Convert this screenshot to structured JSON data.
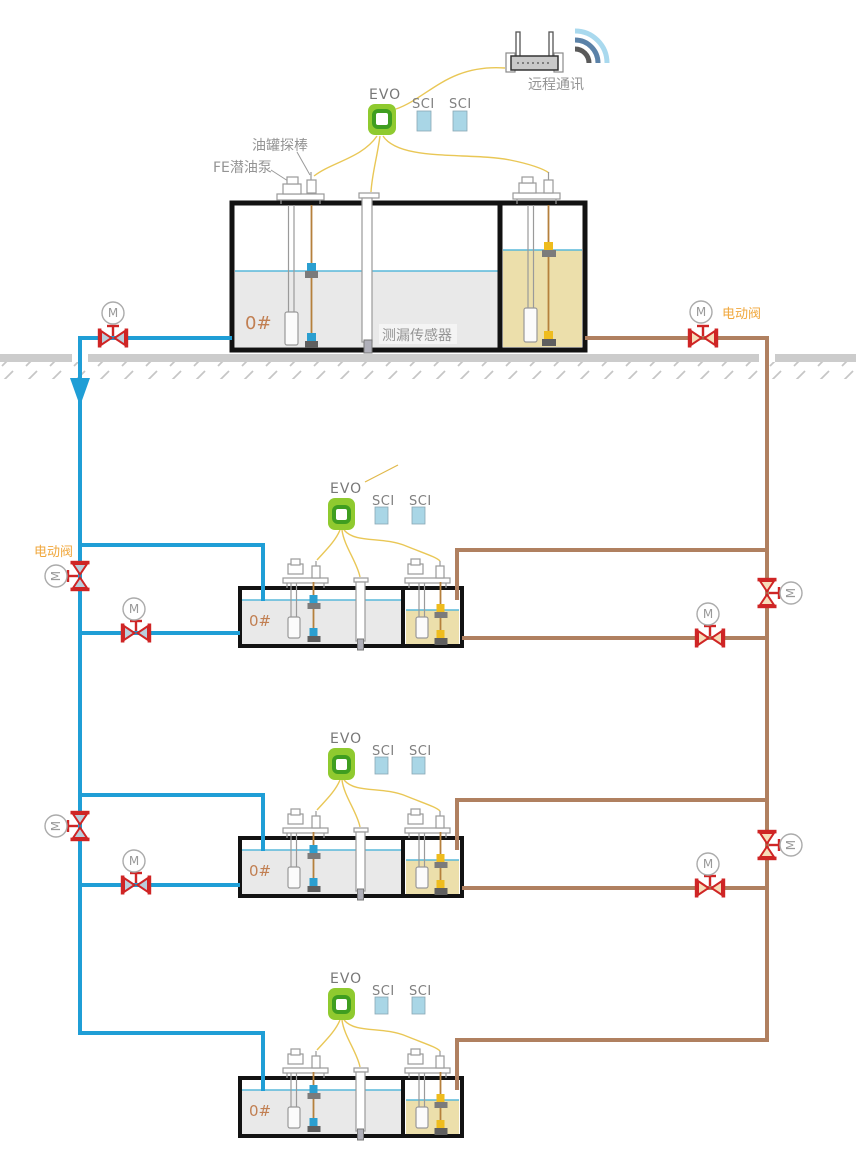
{
  "remote": {
    "label": "远程通讯"
  },
  "annotations": {
    "tank_probe": "油罐探棒",
    "fe_pump": "FE潜油泵",
    "leak_sensor": "测漏传感器",
    "electric_valve_right": "电动阀",
    "electric_valve_left": "电动阀"
  },
  "valve_motor_letter": "M",
  "groups": [
    {
      "id": "main-tank",
      "evo": "EVO",
      "sci_1": "SCI",
      "sci_2": "SCI",
      "grade": "0#"
    },
    {
      "id": "station-2",
      "evo": "EVO",
      "sci_1": "SCI",
      "sci_2": "SCI",
      "grade": "0#"
    },
    {
      "id": "station-3",
      "evo": "EVO",
      "sci_1": "SCI",
      "sci_2": "SCI",
      "grade": "0#"
    },
    {
      "id": "station-4",
      "evo": "EVO",
      "sci_1": "SCI",
      "sci_2": "SCI",
      "grade": "0#"
    }
  ],
  "colors": {
    "pipe_blue": "#1f9ed6",
    "pipe_brown": "#b08060",
    "wire_yellow": "#e9c756",
    "valve_red": "#cf2525",
    "valve_fill_blue": "#b9cfdc",
    "valve_fill_tan": "#f7ddba",
    "tank_border": "#121212",
    "liquid_gray": "#e9e9e9",
    "liquid_tan": "#ecdfab",
    "liquid_line_blue": "#58b8da",
    "evo_green": "#8fca2f",
    "sci_blue": "#a9d6e6",
    "grade_text": "#c17f52",
    "orange_label": "#f0a73c",
    "ground_gray": "#cccccc"
  }
}
